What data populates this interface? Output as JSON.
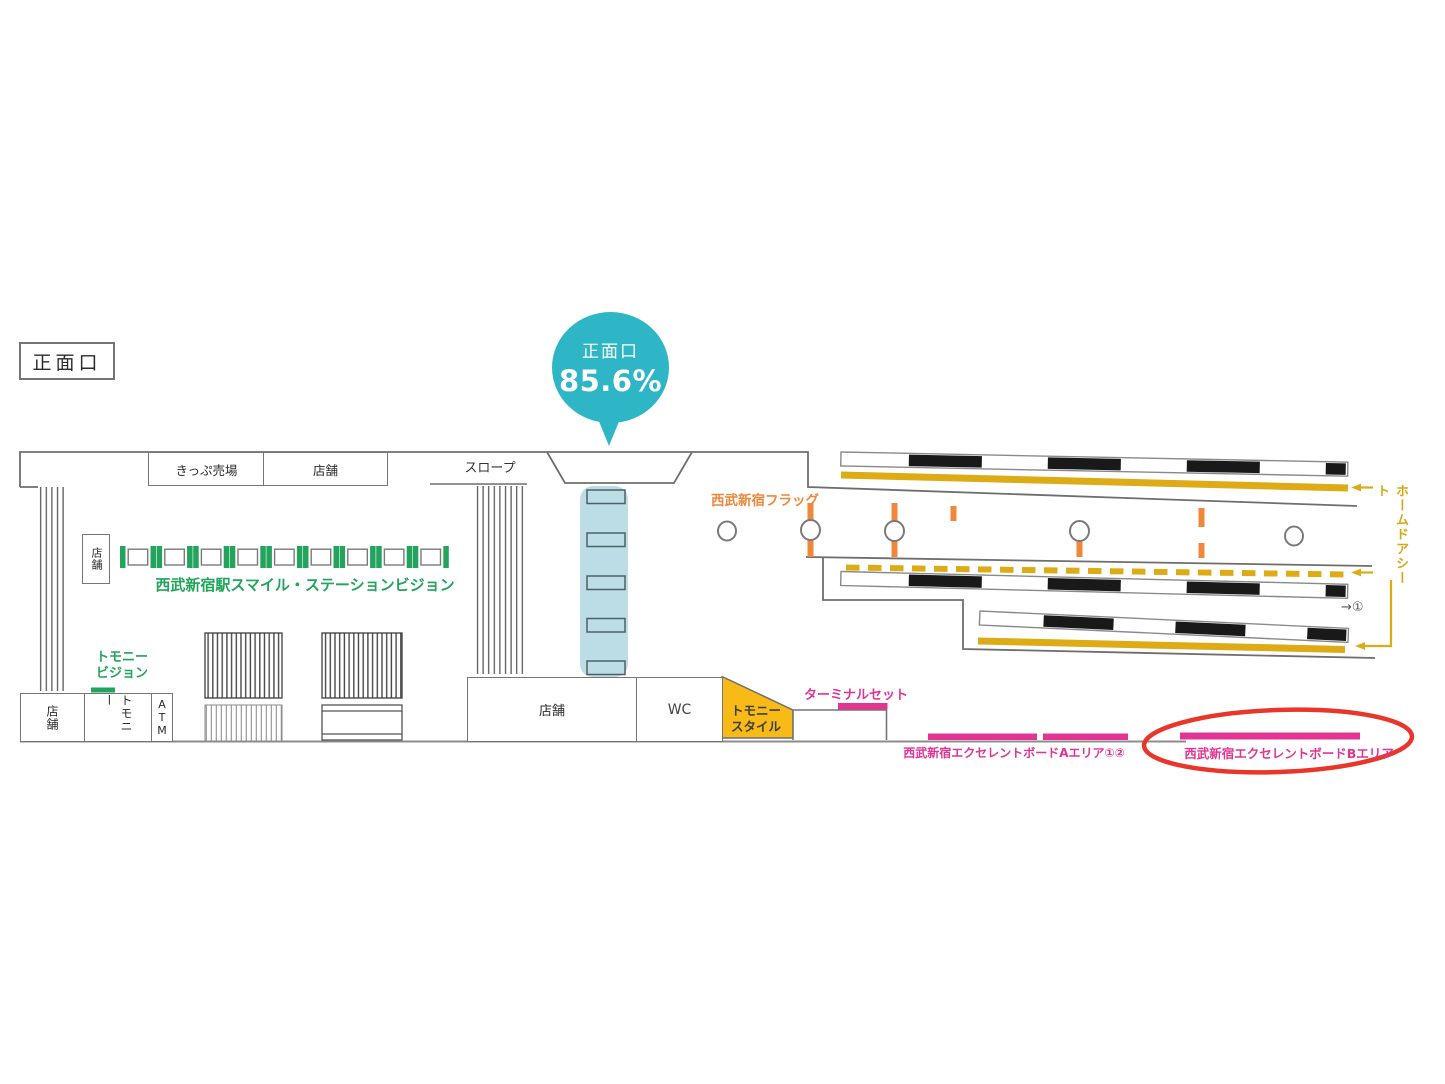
{
  "title": "西武新宿駅 構内図（正面口）",
  "colors": {
    "teal": "#2eb6c6",
    "green": "#22a45c",
    "orange": "#f0873a",
    "gold": "#dcab15",
    "yellow_fill": "#f7ba17",
    "pink": "#e23493",
    "red_highlight": "#e8372a",
    "light_blue": "#bcdde6",
    "wall_gray": "#6e6e6e"
  },
  "map": {
    "entrance": "正面口",
    "balloon": {
      "title": "正面口",
      "value": "85.6%"
    },
    "ticket_office": "きっぷ売場",
    "shop_top": "店舗",
    "slope": "スロープ",
    "shop_small": "店舗",
    "smile_station_vision": "西武新宿駅スマイル・ステーションビジョン",
    "tomony_vision": {
      "line1": "トモニー",
      "line2": "ビジョン"
    },
    "shop_left": "店舗",
    "tomony": "トモニー",
    "atm": "ATM",
    "shop_center": "店舗",
    "wc": "WC",
    "tomony_style": {
      "line1": "トモニー",
      "line2": "スタイル"
    },
    "terminal_set": "ターミナルセット",
    "seibu_flag": "西武新宿フラッグ",
    "home_door_sheet": "ホームドアシート",
    "excellent_board_a": "西武新宿エクセレントボードAエリア①②",
    "excellent_board_b": "西武新宿エクセレントボードBエリア",
    "platform_ref": "→①"
  }
}
